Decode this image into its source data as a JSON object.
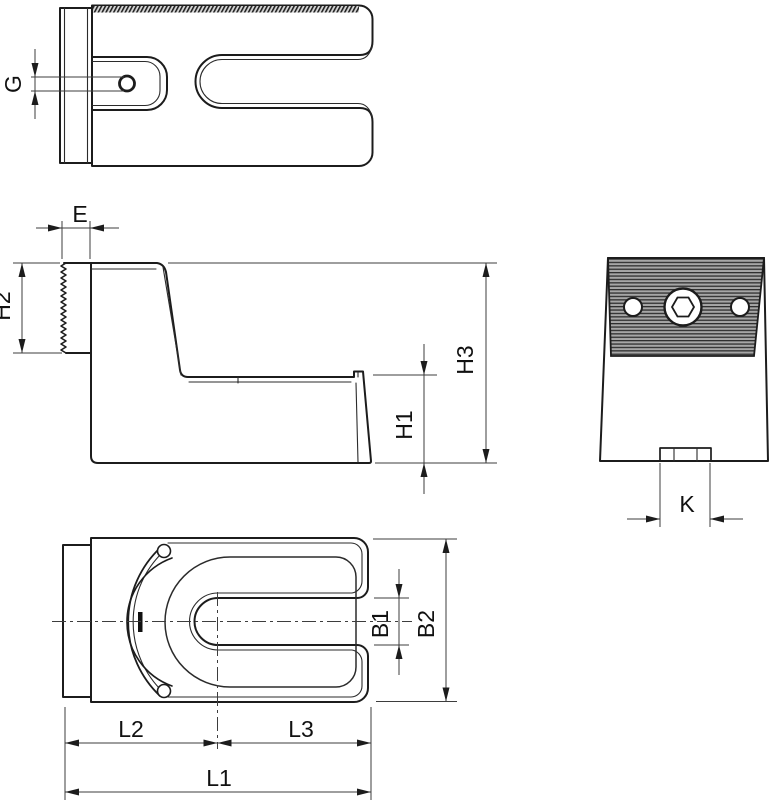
{
  "page": {
    "background": "#ffffff",
    "kind": "technical-drawing"
  },
  "drawing": {
    "line_color": "#1c1c1c",
    "dim_color": "#3d3d3d",
    "serration_fill": "#a6a6a6",
    "serration_stripe": "#2e2e2e",
    "views": {
      "top": {
        "labels": {
          "g": "G"
        }
      },
      "front": {
        "labels": {
          "e": "E",
          "h2": "H2",
          "h3": "H3",
          "h1": "H1"
        }
      },
      "side": {
        "labels": {
          "k": "K"
        }
      },
      "bottom": {
        "labels": {
          "b1": "B1",
          "b2": "B2",
          "l2": "L2",
          "l3": "L3",
          "l1": "L1"
        }
      }
    }
  }
}
